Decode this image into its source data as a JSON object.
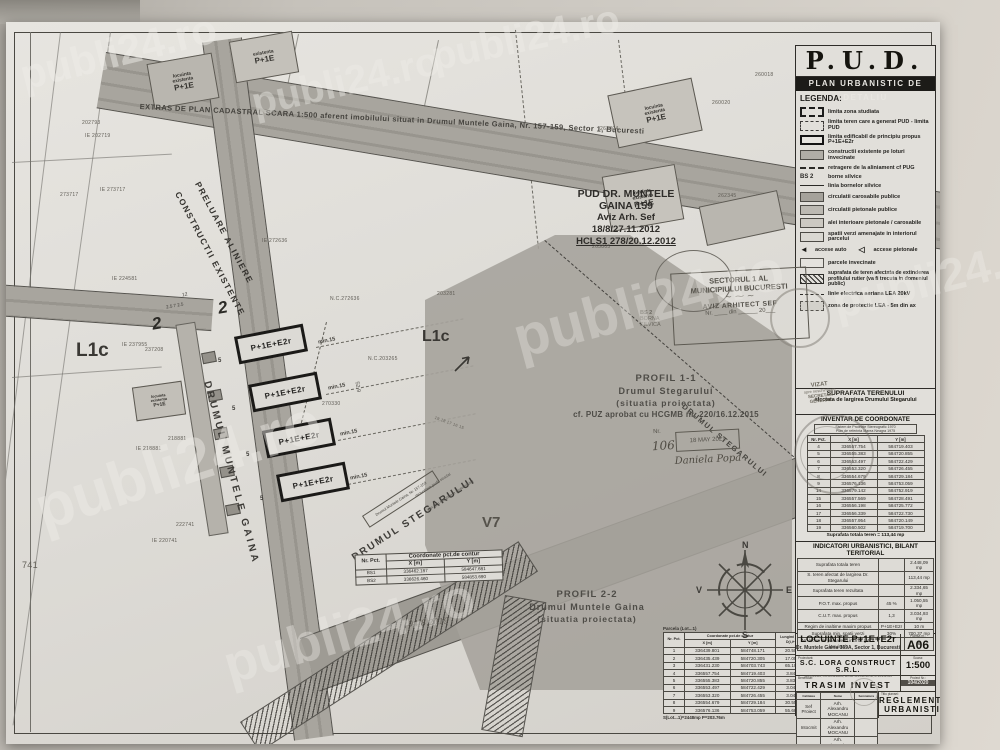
{
  "watermark": "publi24.ro",
  "panel": {
    "pud": "P.U.D.",
    "subtitle": "PLAN URBANISTIC DE DETALIU",
    "legend_title": "LEGENDA:",
    "icons": {
      "arrow_auto": "◄",
      "arrow_ped": "◁"
    },
    "legend": [
      {
        "label": "limita zona studiata"
      },
      {
        "label": "limita teren care a generat PUD - limita PUD"
      },
      {
        "label": "limita edificabil de principiu propus P+1E+E2r"
      },
      {
        "label": "constructii existente pe loturi invecinate"
      },
      {
        "label": "retragere de la aliniament cf PUG"
      },
      {
        "sym_text": "BS 2",
        "label": "borne silvice"
      },
      {
        "label": "linia bornelor silvice"
      },
      {
        "label": "circulatii carosabile publice"
      },
      {
        "label": "circulatii pietonale publice"
      },
      {
        "label": "alei interioare pietonale / carosabile"
      },
      {
        "label": "spatii verzi amenajate in interiorul parcelui"
      },
      {
        "label": "accese auto",
        "label2": "accese pietonale"
      },
      {
        "label": "parcele invecinate"
      },
      {
        "label": "suprafata de teren afectata de extinderea profilului rutier (va fi trecuta in domeniul public)"
      },
      {
        "label": "linie electrica aeriana LEA 20kV"
      },
      {
        "label": "zona de protectie LEA - 5m din ax"
      }
    ],
    "suprafata1": "SUPRAFATA TERENULUI",
    "suprafata2": "afectata de largirea Drumului Stegarului",
    "vizat": {
      "l1": "VIZAT",
      "l2": "spre neschimbare",
      "l3": "SECRETAR GENERAL"
    },
    "inventar": {
      "title": "INVENTAR DE COORDONATE",
      "subtitle1": "Sistem de Proiectie Stereografic 1970",
      "subtitle2": "Plan de referinta Marea Neagra 1975",
      "col_nr": "Nr. Pct.",
      "col_x": "X [m]",
      "col_y": "Y [m]",
      "rows": [
        [
          "4",
          "336557.754",
          "584719.403"
        ],
        [
          "5",
          "336555.383",
          "584720.855"
        ],
        [
          "6",
          "336553.497",
          "584722.429"
        ],
        [
          "7",
          "336553.320",
          "584726.455"
        ],
        [
          "8",
          "336554.679",
          "584729.184"
        ],
        [
          "9",
          "336576.136",
          "584753.059"
        ],
        [
          "14",
          "336579.142",
          "584752.919"
        ],
        [
          "15",
          "336557.569",
          "584728.491"
        ],
        [
          "16",
          "336556.198",
          "584725.772"
        ],
        [
          "17",
          "336556.339",
          "584722.730"
        ],
        [
          "18",
          "336557.954",
          "584720.149"
        ],
        [
          "19",
          "336560.502",
          "584719.700"
        ]
      ],
      "footer": "Suprafata totala teren = 113,44 mp"
    },
    "indicatori": {
      "title": "INDICATORI URBANISTICI, BILANT TERITORIAL",
      "rows": [
        [
          "Suprafata totala teren",
          "",
          "2.448,09 mp"
        ],
        [
          "S. teren afectat de largirea Dr. Stegarului",
          "",
          "113,44 mp"
        ],
        [
          "Suprafata teren rezultata",
          "",
          "2.334,65 mp"
        ],
        [
          "P.O.T. max. propus",
          "45 %",
          "1.050,55 mp"
        ],
        [
          "C.U.T. max. propus",
          "1,3",
          "3.034,93 mp"
        ],
        [
          "Regim de inaltime maxim propus",
          "P+1E+E2r",
          "10 m"
        ],
        [
          "Suprafata min. spatii verzi",
          "30%",
          "700,37 mp"
        ],
        [
          "Nr. locuri de parcare in incinta (pt. 4 locuinte)",
          "",
          "8"
        ]
      ]
    },
    "titleblock": {
      "obiect": "LOCUINTE P+1E+E2r",
      "adresa": "Dr. Muntele Gaina 169A, Sector 1, Bucuresti",
      "plansa_label": "Plansa nr.:",
      "plansa": "A06",
      "proiectant_label": "Proiectant:",
      "proiectant": "S.C. LORA CONSTRUCT S.R.L.",
      "proiectant_sub": "J23/551/1995, CUI RO4298008, tel./fax: 021-212-18-50, 0724-351-665",
      "scara_label": "Scara:",
      "scara": "1:500",
      "beneficiar_label": "Beneficiar:",
      "beneficiar": "TRASIM INVEST SRL",
      "proiect_label": "Proiect Nr.:",
      "proiect": "104/2020",
      "col_calitate": "Calitatea",
      "col_nume": "Nume",
      "col_semn": "Semnatura",
      "rows": [
        [
          "Sef Proiect",
          "Arh. Alexandru MOCANU",
          ""
        ],
        [
          "Intocmit",
          "Arh. Alexandru MOCANU",
          ""
        ],
        [
          "Desenat",
          "Arh. Alexandru MOCANU",
          ""
        ]
      ],
      "titlu_label": "Titlu plansei:",
      "titlu1": "REGLEMENTARI",
      "titlu2": "URBANISTICE"
    }
  },
  "map": {
    "extras": "EXTRAS DE PLAN CADASTRAL SCARA 1:500 aferent imobilului situat in Drumul Muntele Gaina, Nr. 157-159, Sector 1, Bucuresti",
    "pud_box": {
      "l1": "PUD DR. MUNTELE",
      "l2": "GAINA 159",
      "l3": "Aviz Arh. Sef",
      "l4": "18/8/27.11.2012",
      "l5": "HCLS1 278/20.12.2012"
    },
    "preluare1": "PRELUARE ALINIERE",
    "preluare2": "CONSTRUCTII EXISTENTE",
    "profil11": {
      "l1": "PROFIL 1-1",
      "l2": "Drumul Stegarului",
      "l3": "(situatia proiectata)",
      "l4": "cf. PUZ aprobat cu HCGMB nr. 220/16.12.2015"
    },
    "profil22": {
      "l1": "PROFIL 2-2",
      "l2": "Drumul Muntele Gaina",
      "l3": "(situatia proiectata)"
    },
    "street_gaina": "DRUMUL MUNTELE GAINA",
    "street_stegarului": "DRUMUL STEGARULUI",
    "street_note_box": "Drumul Muntele Gaina, Nr. 157-159",
    "street_note1": "dezvoltare profil stradal",
    "street_note2": "alin. (cu mentinere teren silvic)",
    "bldg": "P+1E+E2r",
    "exist": {
      "l1": "locuinta",
      "l2": "existenta",
      "l3": "P+1E"
    },
    "zone1": "L1c",
    "zone2": "L1c",
    "zone3": "V7",
    "dims": {
      "min15": "min.15",
      "five": "5",
      "twelve": "12",
      "profile": "2.5  7  2.5",
      "sec": "2",
      "d529": "52.9"
    },
    "sector_stamp": {
      "l1": "SECTORUL 1 AL",
      "l2": "MUNICIPIULUI BUCURESTI",
      "l3": "AVIZ ARHITECT SEF",
      "l4": "Nr. ____ din ______ 20___"
    },
    "borna": {
      "l1": "BS 2",
      "l2": "BORNA",
      "l3": "SILVICA"
    },
    "reg_stamp": {
      "nr_label": "Nr.",
      "nr": "106",
      "date": "18 MAY 2021",
      "sig": "Daniela Popa"
    },
    "handnote": "04/8.2019",
    "compass": {
      "n": "N",
      "s": "S",
      "e": "E",
      "v": "V"
    },
    "bs_table": {
      "col_nr": "Nr. Pct.",
      "header": "Coordonate pct.de contur",
      "col_x": "X [m]",
      "col_y": "Y [m]",
      "rows": [
        [
          "BS1",
          "336462.187",
          "584647.681"
        ],
        [
          "BS2",
          "336626.460",
          "584853.690"
        ]
      ]
    },
    "parcela_table": {
      "title": "Parcela (Lot...1)",
      "col_nr": "Nr. Pct.",
      "header": "Coordonate pct.de contur",
      "col_x": "X [m]",
      "col_y": "Y [m]",
      "col_l": "Lungimi laturi D(i,i+1)",
      "rows": [
        [
          "1",
          "336439.801",
          "584748.171",
          "20.506"
        ],
        [
          "2",
          "336435.439",
          "584720.305",
          "17.059"
        ],
        [
          "3",
          "336431.230",
          "584703.743",
          "65.108"
        ],
        [
          "4",
          "336557.754",
          "584719.403",
          "3.840"
        ],
        [
          "5",
          "336555.383",
          "584720.855",
          "3.836"
        ],
        [
          "6",
          "336553.497",
          "584722.429",
          "3.040"
        ],
        [
          "7",
          "336553.320",
          "584726.455",
          "3.040"
        ],
        [
          "8",
          "336554.679",
          "584729.184",
          "30.550"
        ],
        [
          "9",
          "336576.136",
          "584753.059",
          "55.687"
        ]
      ],
      "footer": "S(Lot...1)=2448mp  P=203.76m"
    },
    "parcels": [
      "202793",
      "IE 202719",
      "273717",
      "IE 273717",
      "IE 224581",
      "IE 237955",
      "237208",
      "218881",
      "IE 218881",
      "222741",
      "IE 220741",
      "741",
      "IE 272636",
      "N.C.272636",
      "N.C.203265",
      "203281",
      "270330",
      "263805",
      "263804",
      "260018",
      "260020",
      "262345",
      "19  18  17  16  15"
    ]
  }
}
